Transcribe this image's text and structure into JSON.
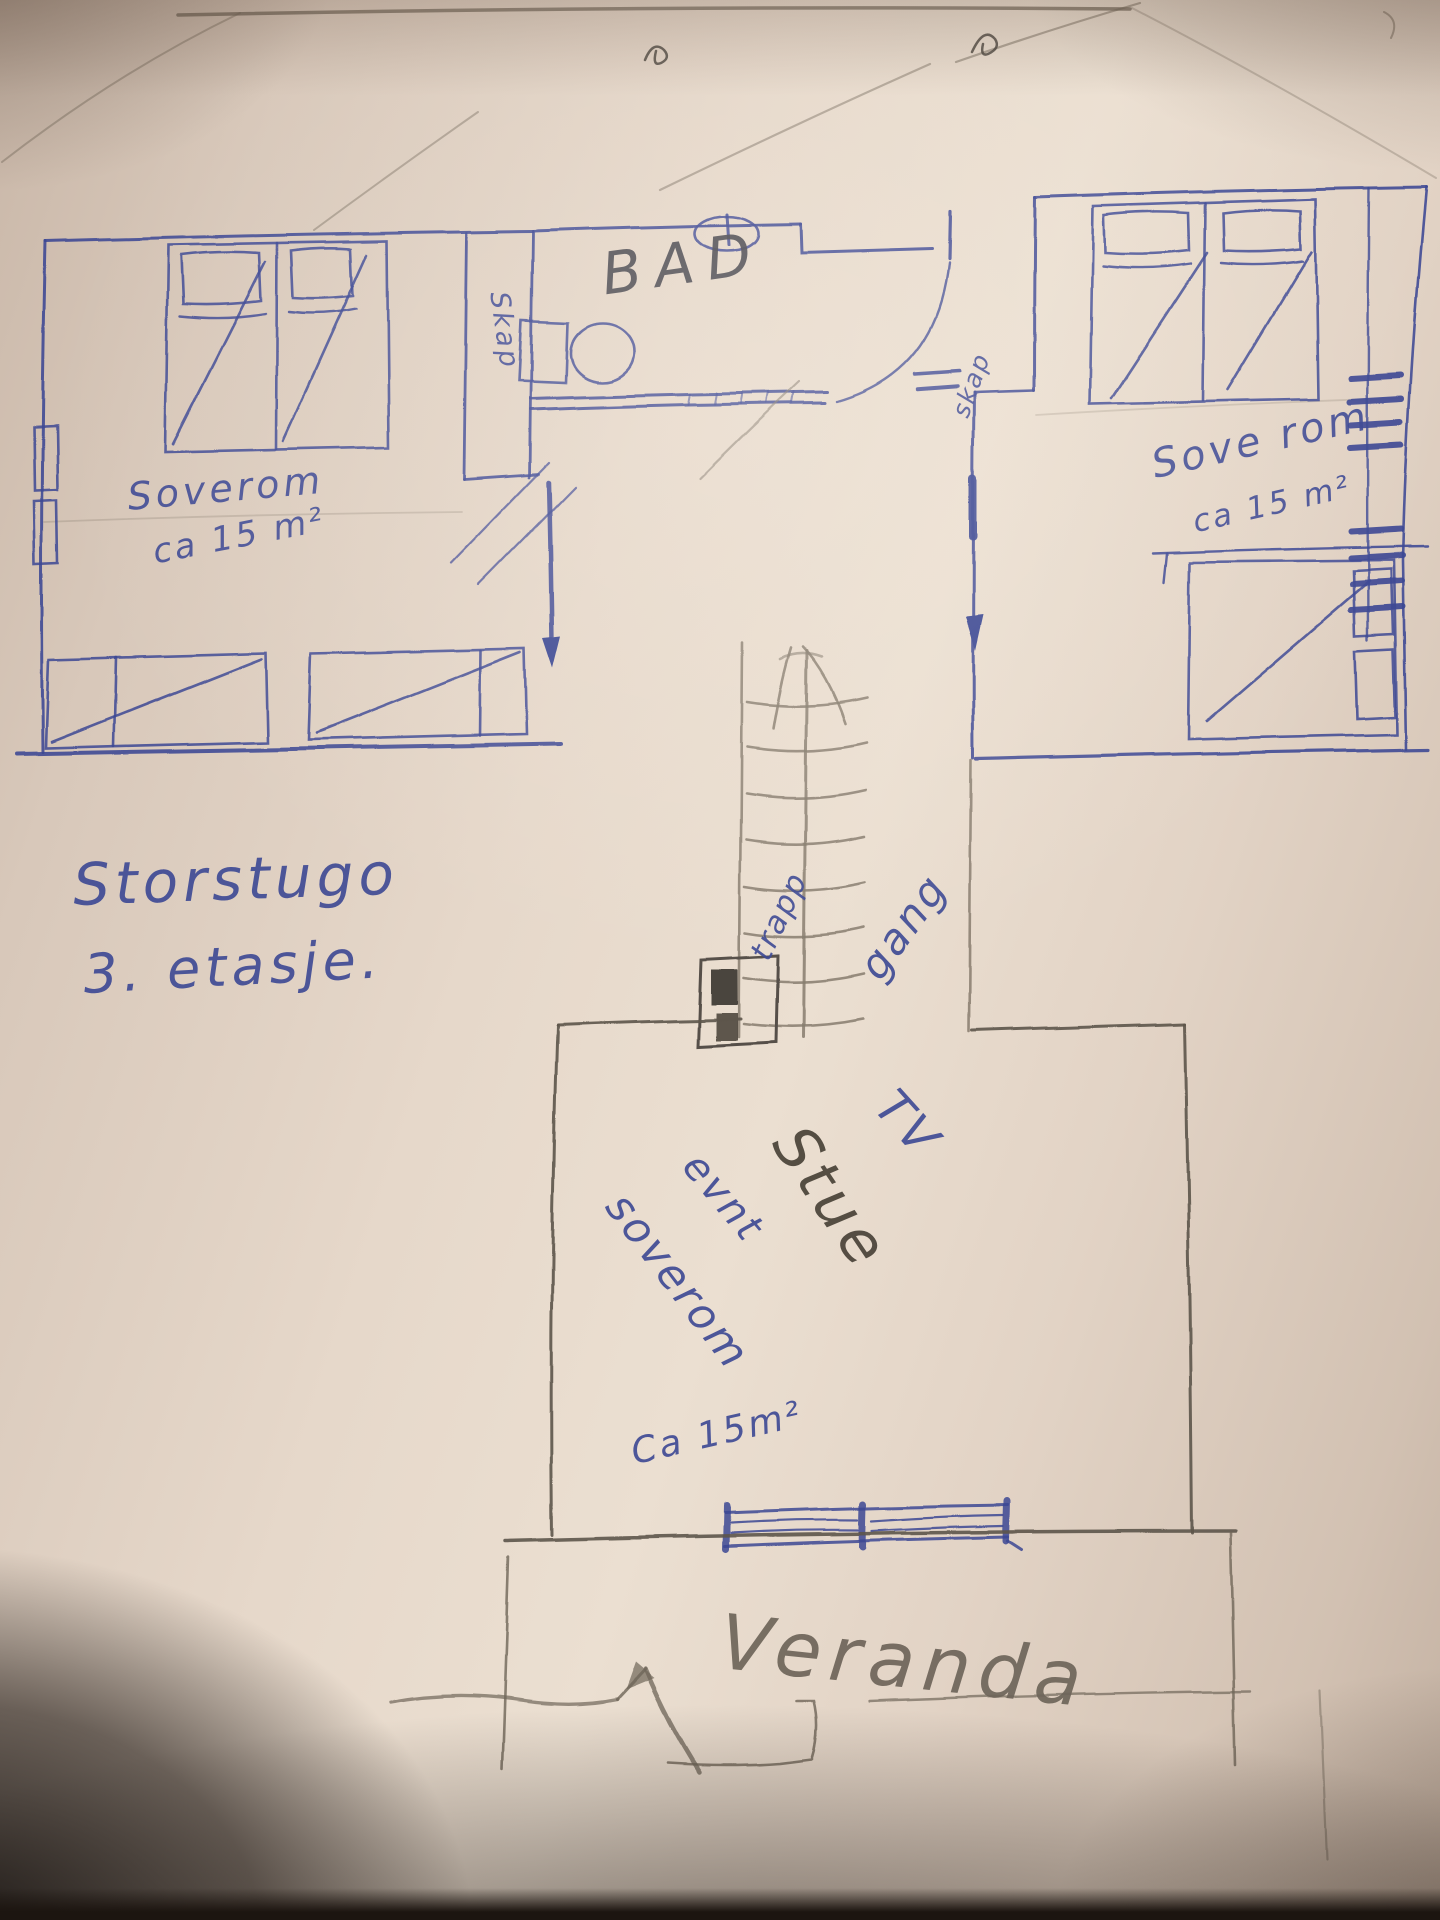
{
  "sketch": {
    "floor_title": "Storstugo",
    "floor_subtitle": "3. etasje.",
    "labels": {
      "bathroom": "BAD",
      "closet_left": "Skap",
      "closet_right": "skap",
      "bedroom_left_name": "Soverom",
      "bedroom_left_area": "ca 15 m²",
      "bedroom_right_name": "Sove rom",
      "bedroom_right_area": "ca 15 m²",
      "stairs": "trapp",
      "hallway": "gang",
      "tv": "TV",
      "living_room": "Stue",
      "optional": "evnt",
      "living_bedroom": "soverom",
      "living_area": "Ca 15m²",
      "veranda": "Veranda"
    },
    "colors": {
      "ink": "#3c4894",
      "pencil": "#6e655a",
      "pencil_dark": "#47464e",
      "paper": "#e8dbcd"
    }
  }
}
